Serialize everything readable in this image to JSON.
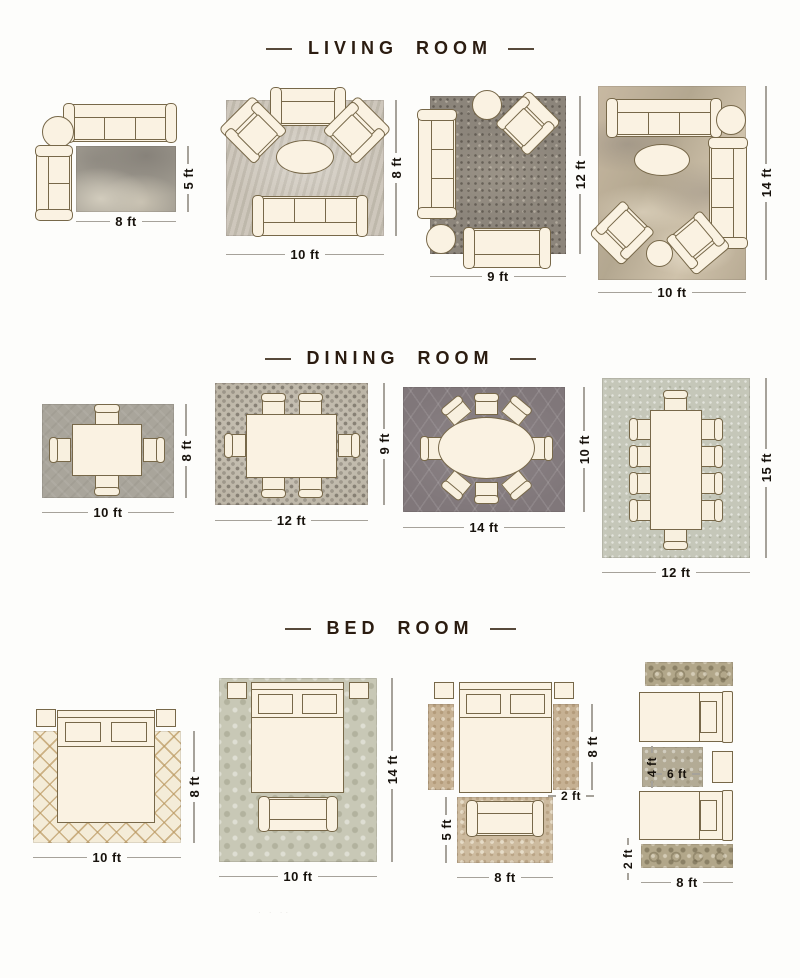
{
  "sections": [
    {
      "id": "living-room",
      "title": "LIVING ROOM",
      "layouts": [
        {
          "rug_width": "8 ft",
          "rug_height": "5 ft"
        },
        {
          "rug_width": "10 ft",
          "rug_height": "8 ft"
        },
        {
          "rug_width": "9 ft",
          "rug_height": "12 ft"
        },
        {
          "rug_width": "10 ft",
          "rug_height": "14 ft"
        }
      ]
    },
    {
      "id": "dining-room",
      "title": "DINING ROOM",
      "layouts": [
        {
          "rug_width": "10 ft",
          "rug_height": "8 ft"
        },
        {
          "rug_width": "12 ft",
          "rug_height": "9 ft"
        },
        {
          "rug_width": "14 ft",
          "rug_height": "10 ft"
        },
        {
          "rug_width": "12 ft",
          "rug_height": "15 ft"
        }
      ]
    },
    {
      "id": "bed-room",
      "title": "BED ROOM",
      "layouts": [
        {
          "rug_width": "10 ft",
          "rug_height": "8 ft"
        },
        {
          "rug_width": "10 ft",
          "rug_height": "14 ft"
        },
        {
          "runner_length": "8 ft",
          "runner_width": "2 ft",
          "rug_width": "8 ft",
          "rug_height": "5 ft"
        },
        {
          "rug_width": "6 ft",
          "rug_height": "4 ft",
          "runner_width": "2 ft",
          "runner_length": "8 ft"
        }
      ]
    }
  ],
  "footer": {
    "dots": "· · ··"
  },
  "colors": {
    "title_text": "#2b1c10",
    "dimension_text": "#17120c",
    "dimension_line": "#a6a29a",
    "furniture_fill": "#faf2e2",
    "furniture_outline": "#776849",
    "background": "#fdfdfb"
  }
}
